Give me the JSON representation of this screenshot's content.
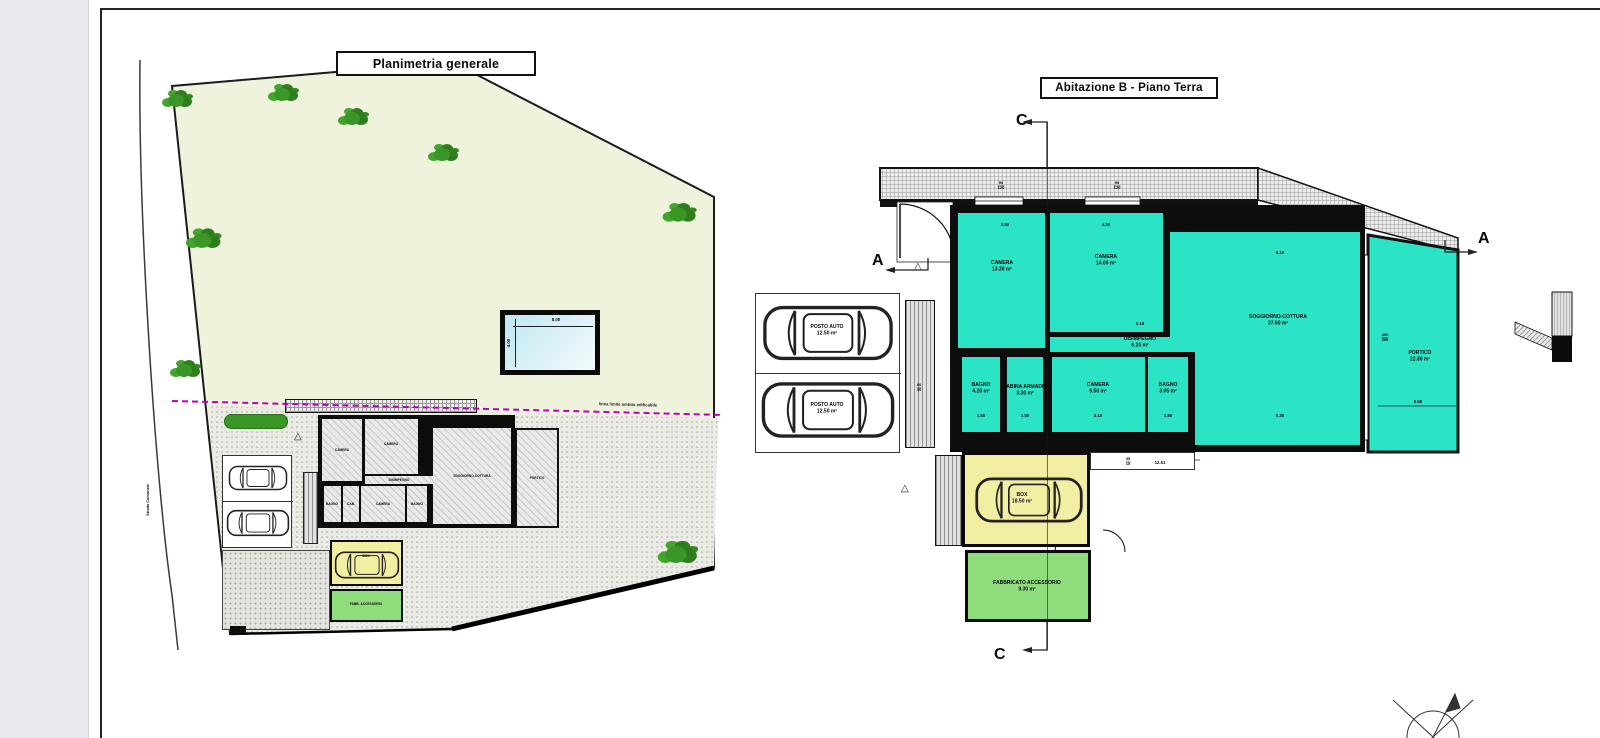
{
  "site_plan": {
    "title": "Planimetria generale",
    "road_label": "Strada Comunale",
    "boundary_label": "linea limite ambito edificabile",
    "pool": {
      "width_dim": "8.00",
      "height_dim": "4.00"
    },
    "mini_labels": [
      "CAMERA",
      "CAMERA",
      "DISIMPEGNO",
      "SOGGIORNO-COTTURA",
      "BAGNO",
      "CAB.",
      "CAMERA",
      "BAGNO",
      "PORTICO",
      "BOX",
      "FABB. ACCESSORIO"
    ]
  },
  "floor_plan": {
    "title": "Abitazione B - Piano Terra",
    "section_c": "C",
    "section_a": "A",
    "rooms": [
      {
        "name": "CAMERA",
        "area": "13.30 m²",
        "dim": "3.80"
      },
      {
        "name": "CAMERA",
        "area": "14.00 m²",
        "dim": "4.20"
      },
      {
        "name": "DISIMPEGNO",
        "area": "6.10 m²",
        "dim": "3.10"
      },
      {
        "name": "SOGGIORNO-COTTURA",
        "area": "37.60 m²",
        "dim_top": "5.10",
        "dim_bottom": "5.30"
      },
      {
        "name": "PORTICO",
        "area": "22.80 m²",
        "dim": "2.60"
      },
      {
        "name": "BAGNO",
        "area": "4.20 m²",
        "dim": "1.50"
      },
      {
        "name": "CABINA ARMADIO",
        "area": "3.30 m²",
        "dim": "1.50"
      },
      {
        "name": "CAMERA",
        "area": "9.50 m²",
        "dim": "3.10"
      },
      {
        "name": "BAGNO",
        "area": "3.05 m²",
        "dim": "1.50"
      }
    ],
    "parking_label": "POSTO AUTO",
    "parking_area": "12.50 m²",
    "box": {
      "name": "BOX",
      "area": "18.50 m²"
    },
    "accessory": {
      "name": "FABBRICATO ACCESSORIO",
      "area": "9.30 m²"
    },
    "dims": {
      "total": "12.51",
      "win_w": "90",
      "win_h": "120",
      "portico_w": "400",
      "portico_h": "300",
      "ramp_w": "80",
      "ramp_h": "40",
      "step_w": "35",
      "step_h": "15"
    }
  },
  "icons": {
    "entrance_triangle": "△"
  },
  "colors": {
    "room_cyan": "#2BE3C5",
    "box_yellow": "#F2EEA2",
    "accessory_green": "#8FDC7C",
    "site_green": "#EFF3DC",
    "tree_green": "#3A9626",
    "pool_blue": "#CDEBF4",
    "boundary_magenta": "#BB00BB"
  }
}
